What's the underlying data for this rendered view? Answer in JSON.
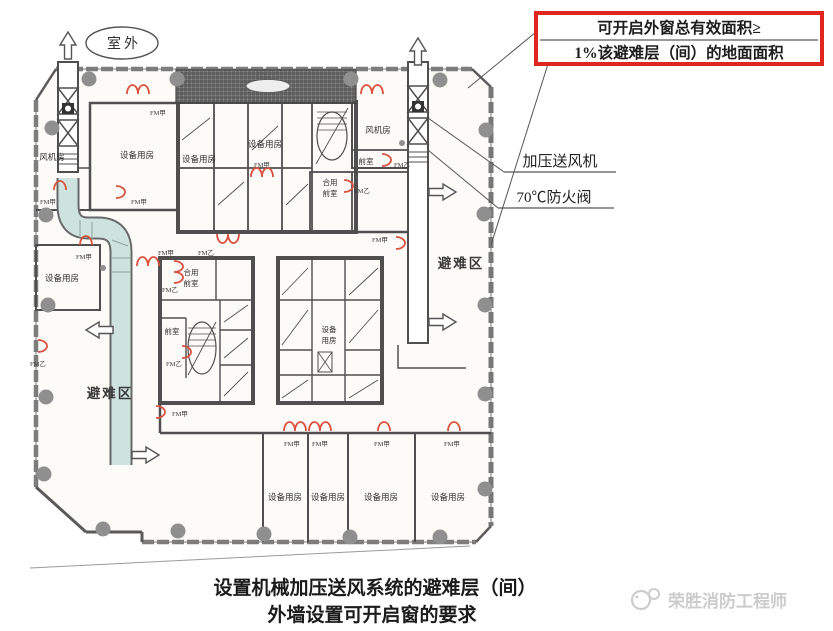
{
  "annotation_box": {
    "line1": "可开启外窗总有效面积≥",
    "line2": "1%该避难层（间）的地面面积"
  },
  "callouts": {
    "fan": "加压送风机",
    "damper": "70℃防火阀"
  },
  "plan": {
    "outdoor": "室外",
    "refuge_area": "避难区",
    "equipment_room": "设备用房",
    "fan_room": "风机房",
    "anteroom": "前室",
    "shared_anteroom_line1": "合用",
    "shared_anteroom_line2": "前室",
    "equipment_room_v1": "设备",
    "equipment_room_v2": "用房",
    "door_class_a": "FM甲",
    "door_class_b": "FM乙"
  },
  "caption": {
    "line1": "设置机械加压送风系统的避难层（间）",
    "line2": "外墙设置可开启窗的要求"
  },
  "watermark": {
    "text": "荣胜消防工程师"
  },
  "colors": {
    "annotation_red": "#e0261d",
    "door_red": "#d9503f",
    "duct_teal": "#cfe3de",
    "wall_gray": "#4f4f4f"
  }
}
